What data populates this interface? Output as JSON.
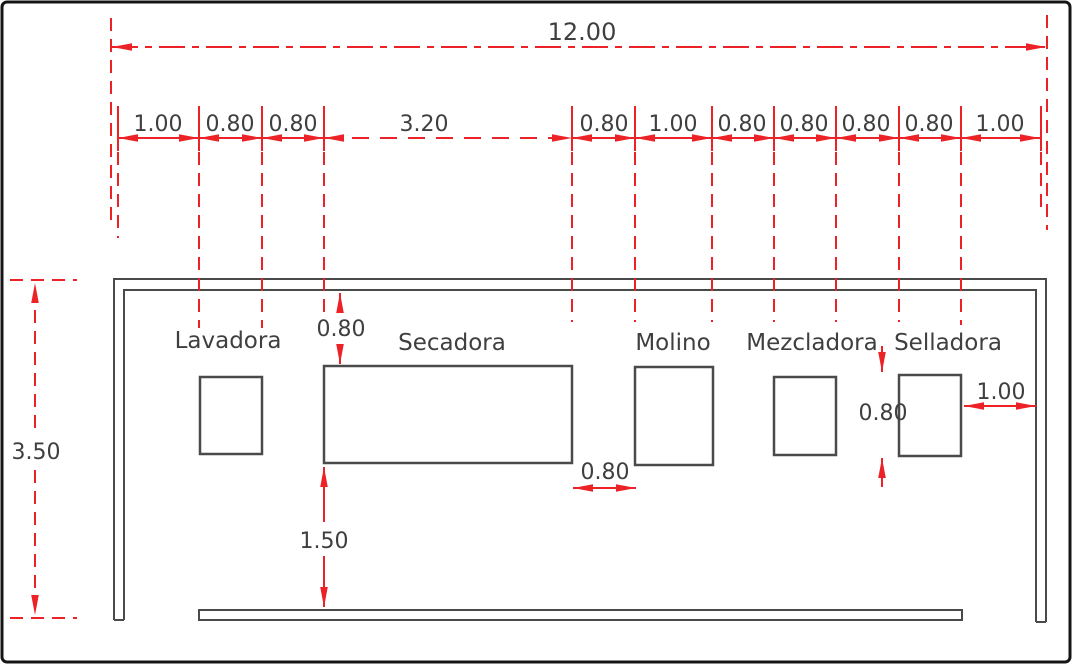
{
  "colors": {
    "dimension_red": "#ec2227",
    "line_gray": "#4a4a4a",
    "text_gray": "#3f3f3f"
  },
  "dimensions": {
    "total_width": "12.00",
    "segments": [
      "1.00",
      "0.80",
      "0.80",
      "3.20",
      "0.80",
      "1.00",
      "0.80",
      "0.80",
      "0.80",
      "0.80",
      "1.00"
    ],
    "room_height": "3.50",
    "secadora_top_gap": "0.80",
    "secadora_molino_gap": "0.80",
    "secadora_front_clearance": "1.50",
    "selladora_height": "0.80",
    "selladora_wall_gap": "1.00"
  },
  "machines": [
    {
      "label": "Lavadora"
    },
    {
      "label": "Secadora"
    },
    {
      "label": "Molino"
    },
    {
      "label": "Mezcladora"
    },
    {
      "label": "Selladora"
    }
  ]
}
